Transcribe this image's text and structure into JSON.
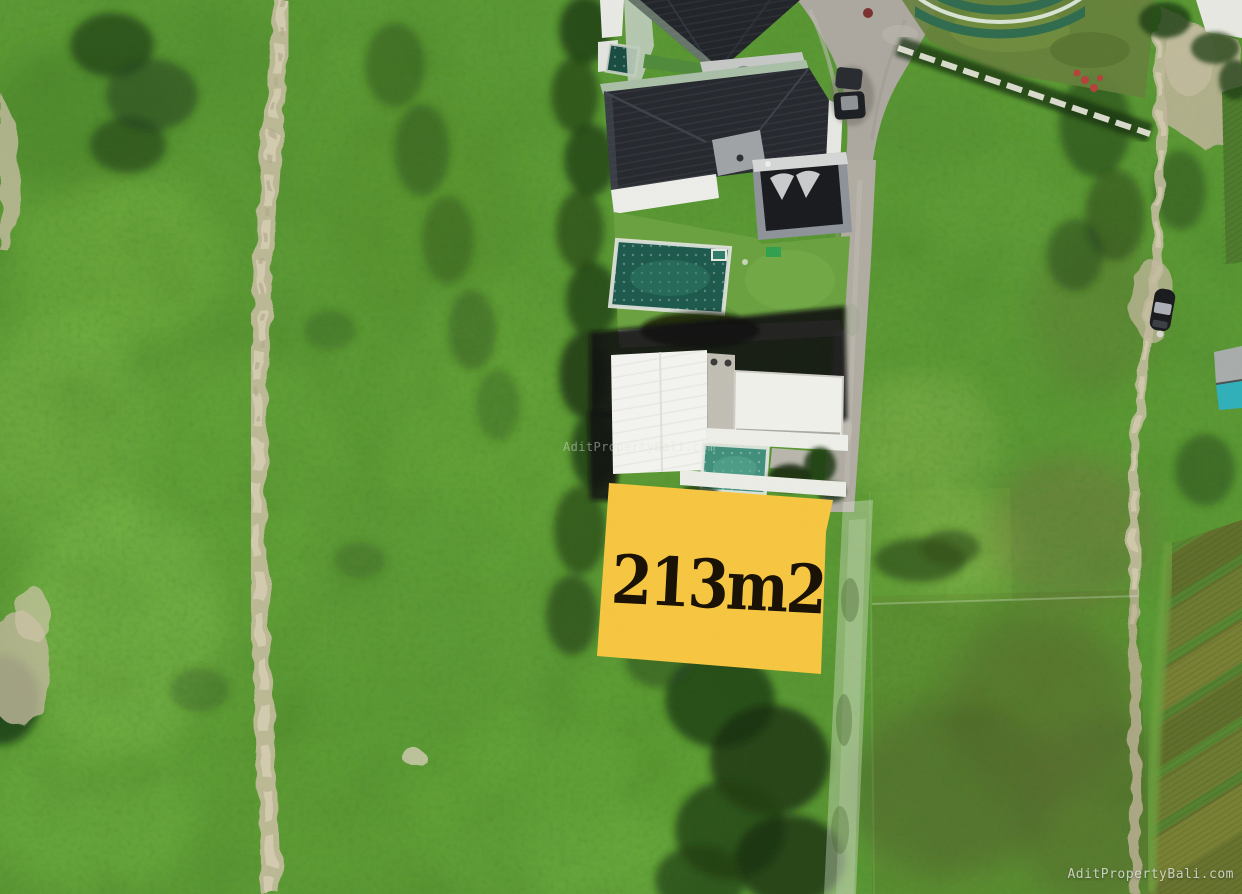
{
  "plot": {
    "area_label": "213m2",
    "fill_color": "#F7C63F",
    "label_color": "#1A1305"
  },
  "watermarks": {
    "center": "AditPropertyBali.com",
    "bottom_right": "AditPropertyBali.com"
  },
  "palette": {
    "grass_base": "#5C9A33",
    "grass_bright": "#7DB141",
    "grass_dark": "#2F5718",
    "scrub_dark": "#1E3A12",
    "dirt_path": "#C9BFA4",
    "road_gray": "#ACA89F",
    "roof_dark": "#24272D",
    "building_white": "#F2F2EE",
    "pool_teal_dark": "#1B584B",
    "pool_teal_bright": "#3F8F7A",
    "paddy_olive": "#6B7A2E",
    "shack_teal": "#2EB0BA"
  }
}
